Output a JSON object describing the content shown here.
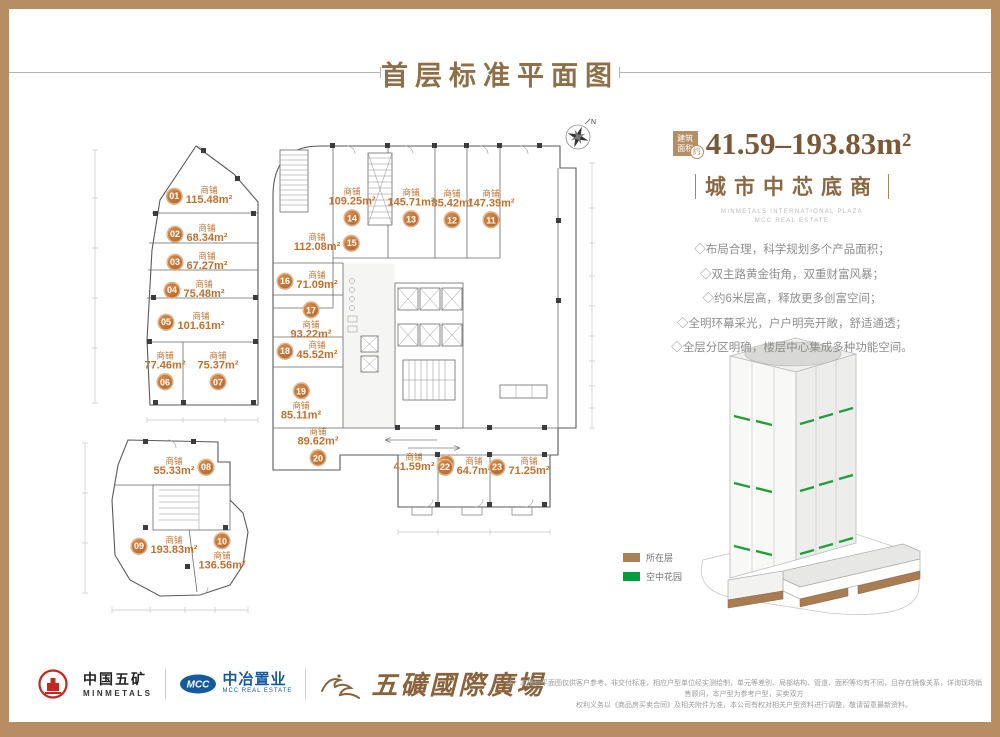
{
  "page": {
    "title": "首层标准平面图"
  },
  "info_panel": {
    "badge": {
      "line1": "建筑",
      "line2": "面积",
      "approx": "约"
    },
    "area_range": "41.59–193.83m²",
    "headline": "城市中芯底商",
    "caption_en_1": "MINMETALS INTERNATIONAL PLAZA",
    "caption_en_2": "MCC REAL ESTATE",
    "selling_points": [
      "◇布局合理，科学规划多个产品面积；",
      "◇双主路黄金街角，双重财富风暴；",
      "◇约6米层高，释放更多创富空间；",
      "◇全明环幕采光，户户明亮开敞，舒适通透；",
      "◇全层分区明确，楼层中心集成多种功能空间。"
    ]
  },
  "legend": {
    "items": [
      {
        "label": "所在层",
        "color": "#ab7f58"
      },
      {
        "label": "空中花园",
        "color": "#019f3c"
      }
    ]
  },
  "floor_plan": {
    "unit_label": "商铺",
    "compass": "N",
    "shops": [
      {
        "no": "01",
        "area": "115.48m²",
        "x": 199,
        "y": 196,
        "v": "l"
      },
      {
        "no": "02",
        "area": "68.34m²",
        "x": 197,
        "y": 234,
        "v": "l"
      },
      {
        "no": "03",
        "area": "67.27m²",
        "x": 197,
        "y": 262,
        "v": "l"
      },
      {
        "no": "04",
        "area": "75.48m²",
        "x": 194,
        "y": 290,
        "v": "l"
      },
      {
        "no": "05",
        "area": "101.61m²",
        "x": 191,
        "y": 322,
        "v": "l"
      },
      {
        "no": "06",
        "area": "77.46m²",
        "x": 165,
        "y": 371,
        "v": "b"
      },
      {
        "no": "07",
        "area": "75.37m²",
        "x": 218,
        "y": 371,
        "v": "b"
      },
      {
        "no": "08",
        "area": "55.33m²",
        "x": 184,
        "y": 467,
        "v": "r"
      },
      {
        "no": "09",
        "area": "193.83m²",
        "x": 164,
        "y": 546,
        "v": "l"
      },
      {
        "no": "10",
        "area": "136.56m²",
        "x": 222,
        "y": 552,
        "v": "a"
      },
      {
        "no": "11",
        "area": "147.39m²",
        "x": 491,
        "y": 209,
        "v": "b"
      },
      {
        "no": "12",
        "area": "85.42m²",
        "x": 452,
        "y": 209,
        "v": "b"
      },
      {
        "no": "13",
        "area": "145.71m²",
        "x": 411,
        "y": 208,
        "v": "b"
      },
      {
        "no": "14",
        "area": "109.25m²",
        "x": 352,
        "y": 207,
        "v": "b"
      },
      {
        "no": "15",
        "area": "112.08m²",
        "x": 327,
        "y": 243,
        "v": "r"
      },
      {
        "no": "16",
        "area": "71.09m²",
        "x": 307,
        "y": 281,
        "v": "l"
      },
      {
        "no": "17",
        "area": "93.22m²",
        "x": 311,
        "y": 321,
        "v": "a"
      },
      {
        "no": "18",
        "area": "45.52m²",
        "x": 307,
        "y": 351,
        "v": "l"
      },
      {
        "no": "19",
        "area": "85.11m²",
        "x": 301,
        "y": 402,
        "v": "a"
      },
      {
        "no": "20",
        "area": "89.62m²",
        "x": 318,
        "y": 447,
        "v": "b"
      },
      {
        "no": "21",
        "area": "41.59m²",
        "x": 424,
        "y": 463,
        "v": "r"
      },
      {
        "no": "22",
        "area": "64.7m²",
        "x": 464,
        "y": 467,
        "v": "l"
      },
      {
        "no": "23",
        "area": "71.25m²",
        "x": 519,
        "y": 467,
        "v": "l"
      }
    ]
  },
  "footer": {
    "brand_minmetals": {
      "cn": "中国五矿",
      "en": "MINMETALS"
    },
    "brand_mcc": {
      "logo": "MCC",
      "cn": "中冶置业",
      "en": "MCC REAL ESTATE"
    },
    "project_name": "五礦國際廣場",
    "disclaimer_line1": "注：本楼层平面图仅供客户参考，非交付标准，相应户型单位经实测绘制，单元等差别、局部结构、管道、面积等均有不同，且存在镜像关系，详询现场销售顾问，本户型为参考户型，买卖双方",
    "disclaimer_line2": "权利义务以《商品房买卖合同》及相关附件为准，本公司有权对相关户型资料进行调整，敬请留意最新资料。"
  },
  "colors": {
    "accent_brown": "#b78e63",
    "shop_orange": "#c0702d",
    "sky_garden_green": "#019f3c"
  }
}
